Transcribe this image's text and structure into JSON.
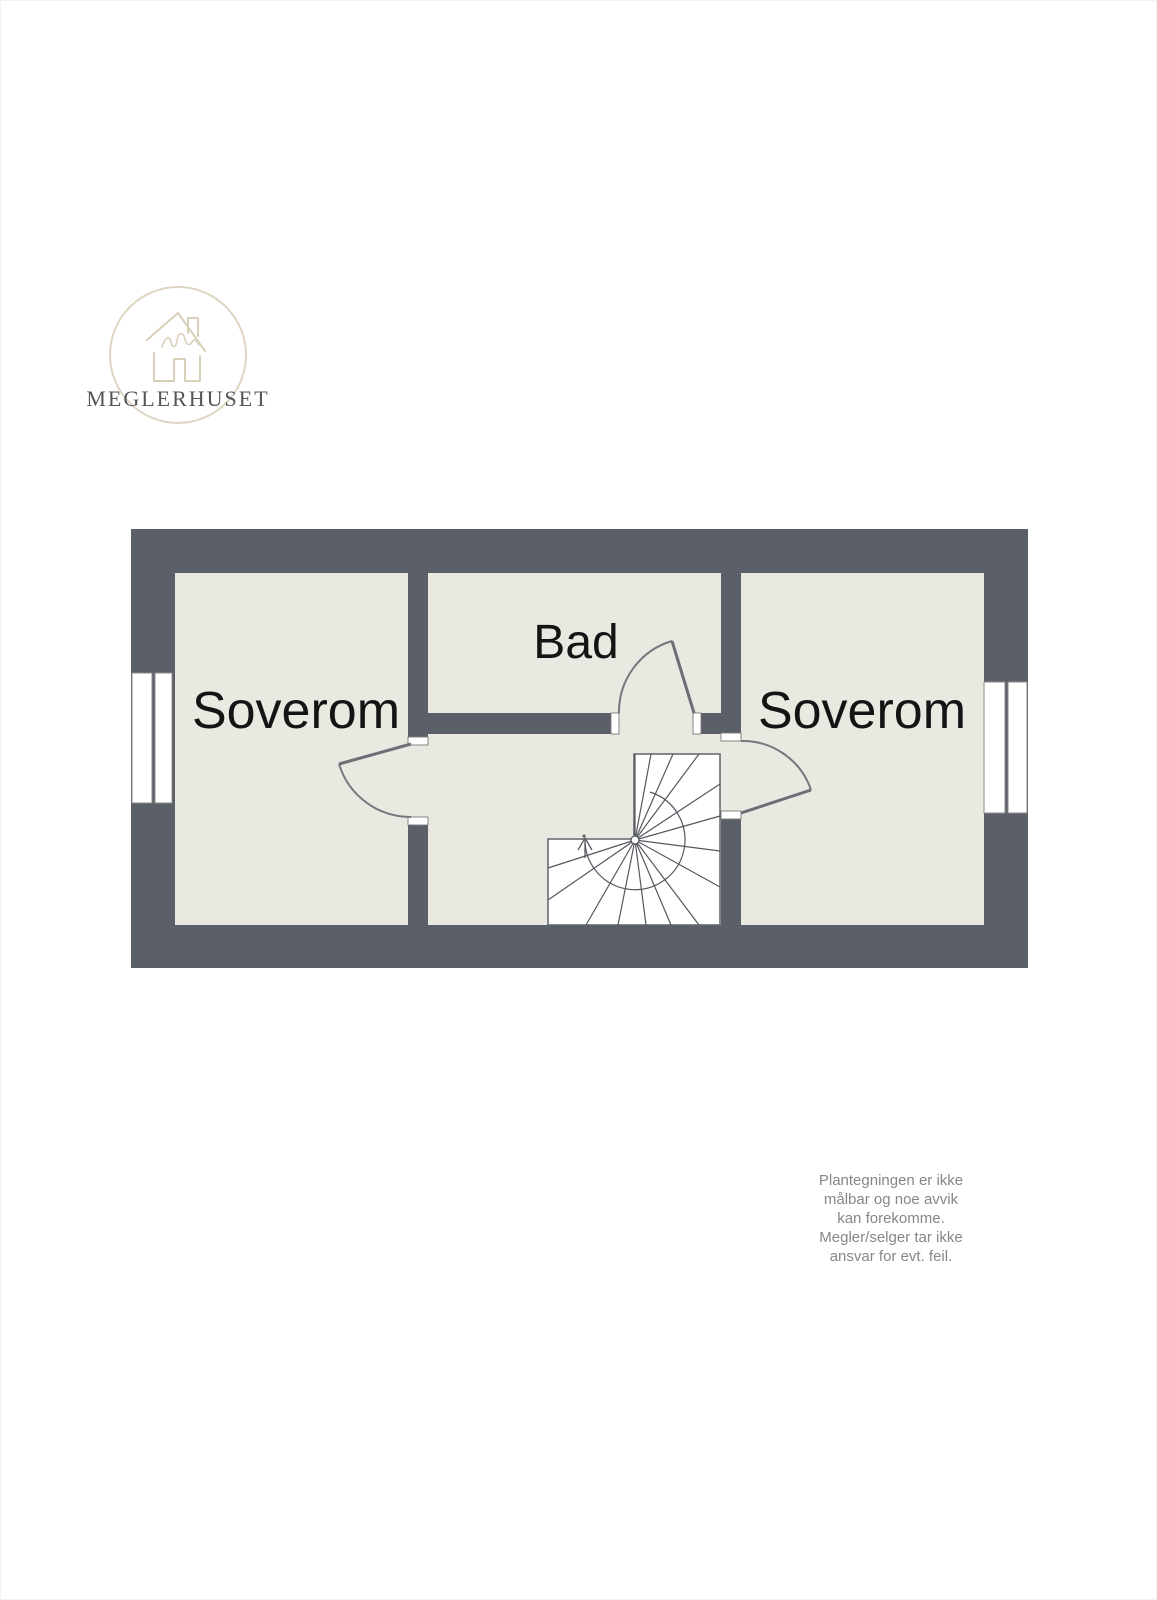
{
  "brand": {
    "name": "MEGLERHUSET"
  },
  "floorplan": {
    "rooms": [
      {
        "name": "bedroom-left",
        "label": "Soverom"
      },
      {
        "name": "bathroom",
        "label": "Bad"
      },
      {
        "name": "bedroom-right",
        "label": "Soverom"
      }
    ],
    "colors": {
      "wall": "#5b5f68",
      "room_fill": "#e9e8e1",
      "stair_fill": "#ffffff",
      "label_text": "#141414"
    }
  },
  "logo_colors": {
    "circle": "#ded5c2",
    "house": "#d9d0ba",
    "text": "#55565b"
  },
  "disclaimer": {
    "color": "#878787",
    "lines": [
      "Plantegningen er ikke",
      "målbar og noe avvik",
      "kan forekomme.",
      "Megler/selger tar ikke",
      "ansvar for evt. feil."
    ]
  }
}
